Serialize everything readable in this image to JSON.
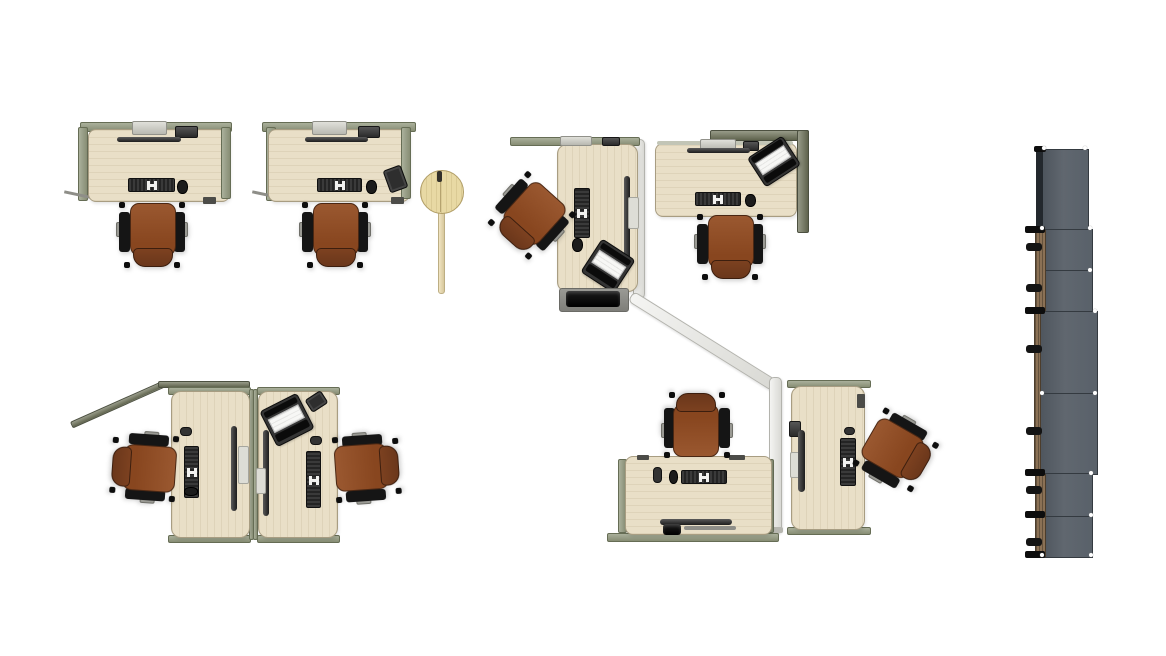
{
  "scene": {
    "description": "Top-down rendering of an office floor plan: six workstation desks with brown task chairs, privacy screens, a round personal table and a column of storage lockers",
    "background": "#ffffff"
  },
  "palette": {
    "background": "#ffffff",
    "desk_surface": "#e9dfc7",
    "panel_sage": "#9aa08c",
    "panel_olive": "#6e7260",
    "divider_white": "#ebebe8",
    "chair_seat": "#9a5830",
    "chair_back": "#6b371b",
    "chair_arms": "#151515",
    "device_dark": "#2c2c2c",
    "laptop_screen": "#f7f7f5",
    "storage_body": "#59616a",
    "storage_wood": "#8b7155",
    "table_round": "#e8d9a4"
  },
  "clusters": [
    {
      "id": "top-left-row",
      "desks": 2,
      "chairs": 2,
      "accessories": [
        "docking-unit",
        "monitor-bar",
        "keyboard",
        "mouse",
        "phone",
        "tablet"
      ],
      "extras": [
        "round-personal-table"
      ]
    },
    {
      "id": "center-l-cluster",
      "desks": 2,
      "chairs": 2,
      "accessories": [
        "keyboard",
        "mouse",
        "monitor-bar",
        "laptop",
        "cpu-cart",
        "docking-unit"
      ],
      "panels": [
        "white-zigzag-screen",
        "olive-corner-panel"
      ]
    },
    {
      "id": "bottom-left-pair",
      "desks": 2,
      "chairs": 2,
      "accessories": [
        "keyboard",
        "mouse",
        "monitor-bar",
        "laptop",
        "tablet"
      ],
      "panels": [
        "angled-rail"
      ]
    },
    {
      "id": "bottom-center-pair",
      "desks": 2,
      "chairs": 2,
      "accessories": [
        "keyboard",
        "mouse",
        "monitor-bar",
        "cpu"
      ],
      "panels": [
        "white-zigzag-screen"
      ]
    }
  ],
  "storage_stack": {
    "units": 7,
    "drawer_handles": 6,
    "orientation": "vertical-column",
    "position": "right-edge"
  }
}
